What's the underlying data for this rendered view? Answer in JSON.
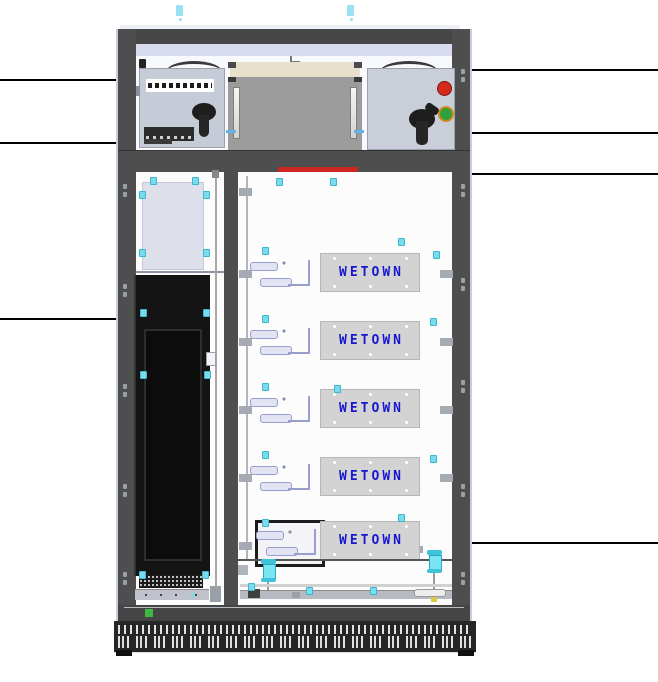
{
  "cabinet": {
    "title": "battery-cabinet-front-view",
    "modules": [
      {
        "label": "WETOWN"
      },
      {
        "label": "WETOWN"
      },
      {
        "label": "WETOWN"
      },
      {
        "label": "WETOWN"
      },
      {
        "label": "WETOWN"
      }
    ],
    "colors": {
      "frame": "#4e4e4e",
      "panel": "#fcfcfd",
      "unit_grey": "#c6ccd7",
      "transformer_body": "#9c9c9c",
      "transformer_top": "#e8e0cb",
      "door_black": "#141414",
      "module_box": "#d3d3d3",
      "brand_blue": "#1717cf",
      "alarm_bar_red": "#cb2721",
      "red_button": "#d42a1e",
      "green_button": "#2fa03a",
      "status_led_green": "#3cb843",
      "insulator_cyan": "#79e4f2",
      "marker_cyan": "#79dcee"
    },
    "callouts": {
      "left_count": 3,
      "right_count": 4
    }
  }
}
